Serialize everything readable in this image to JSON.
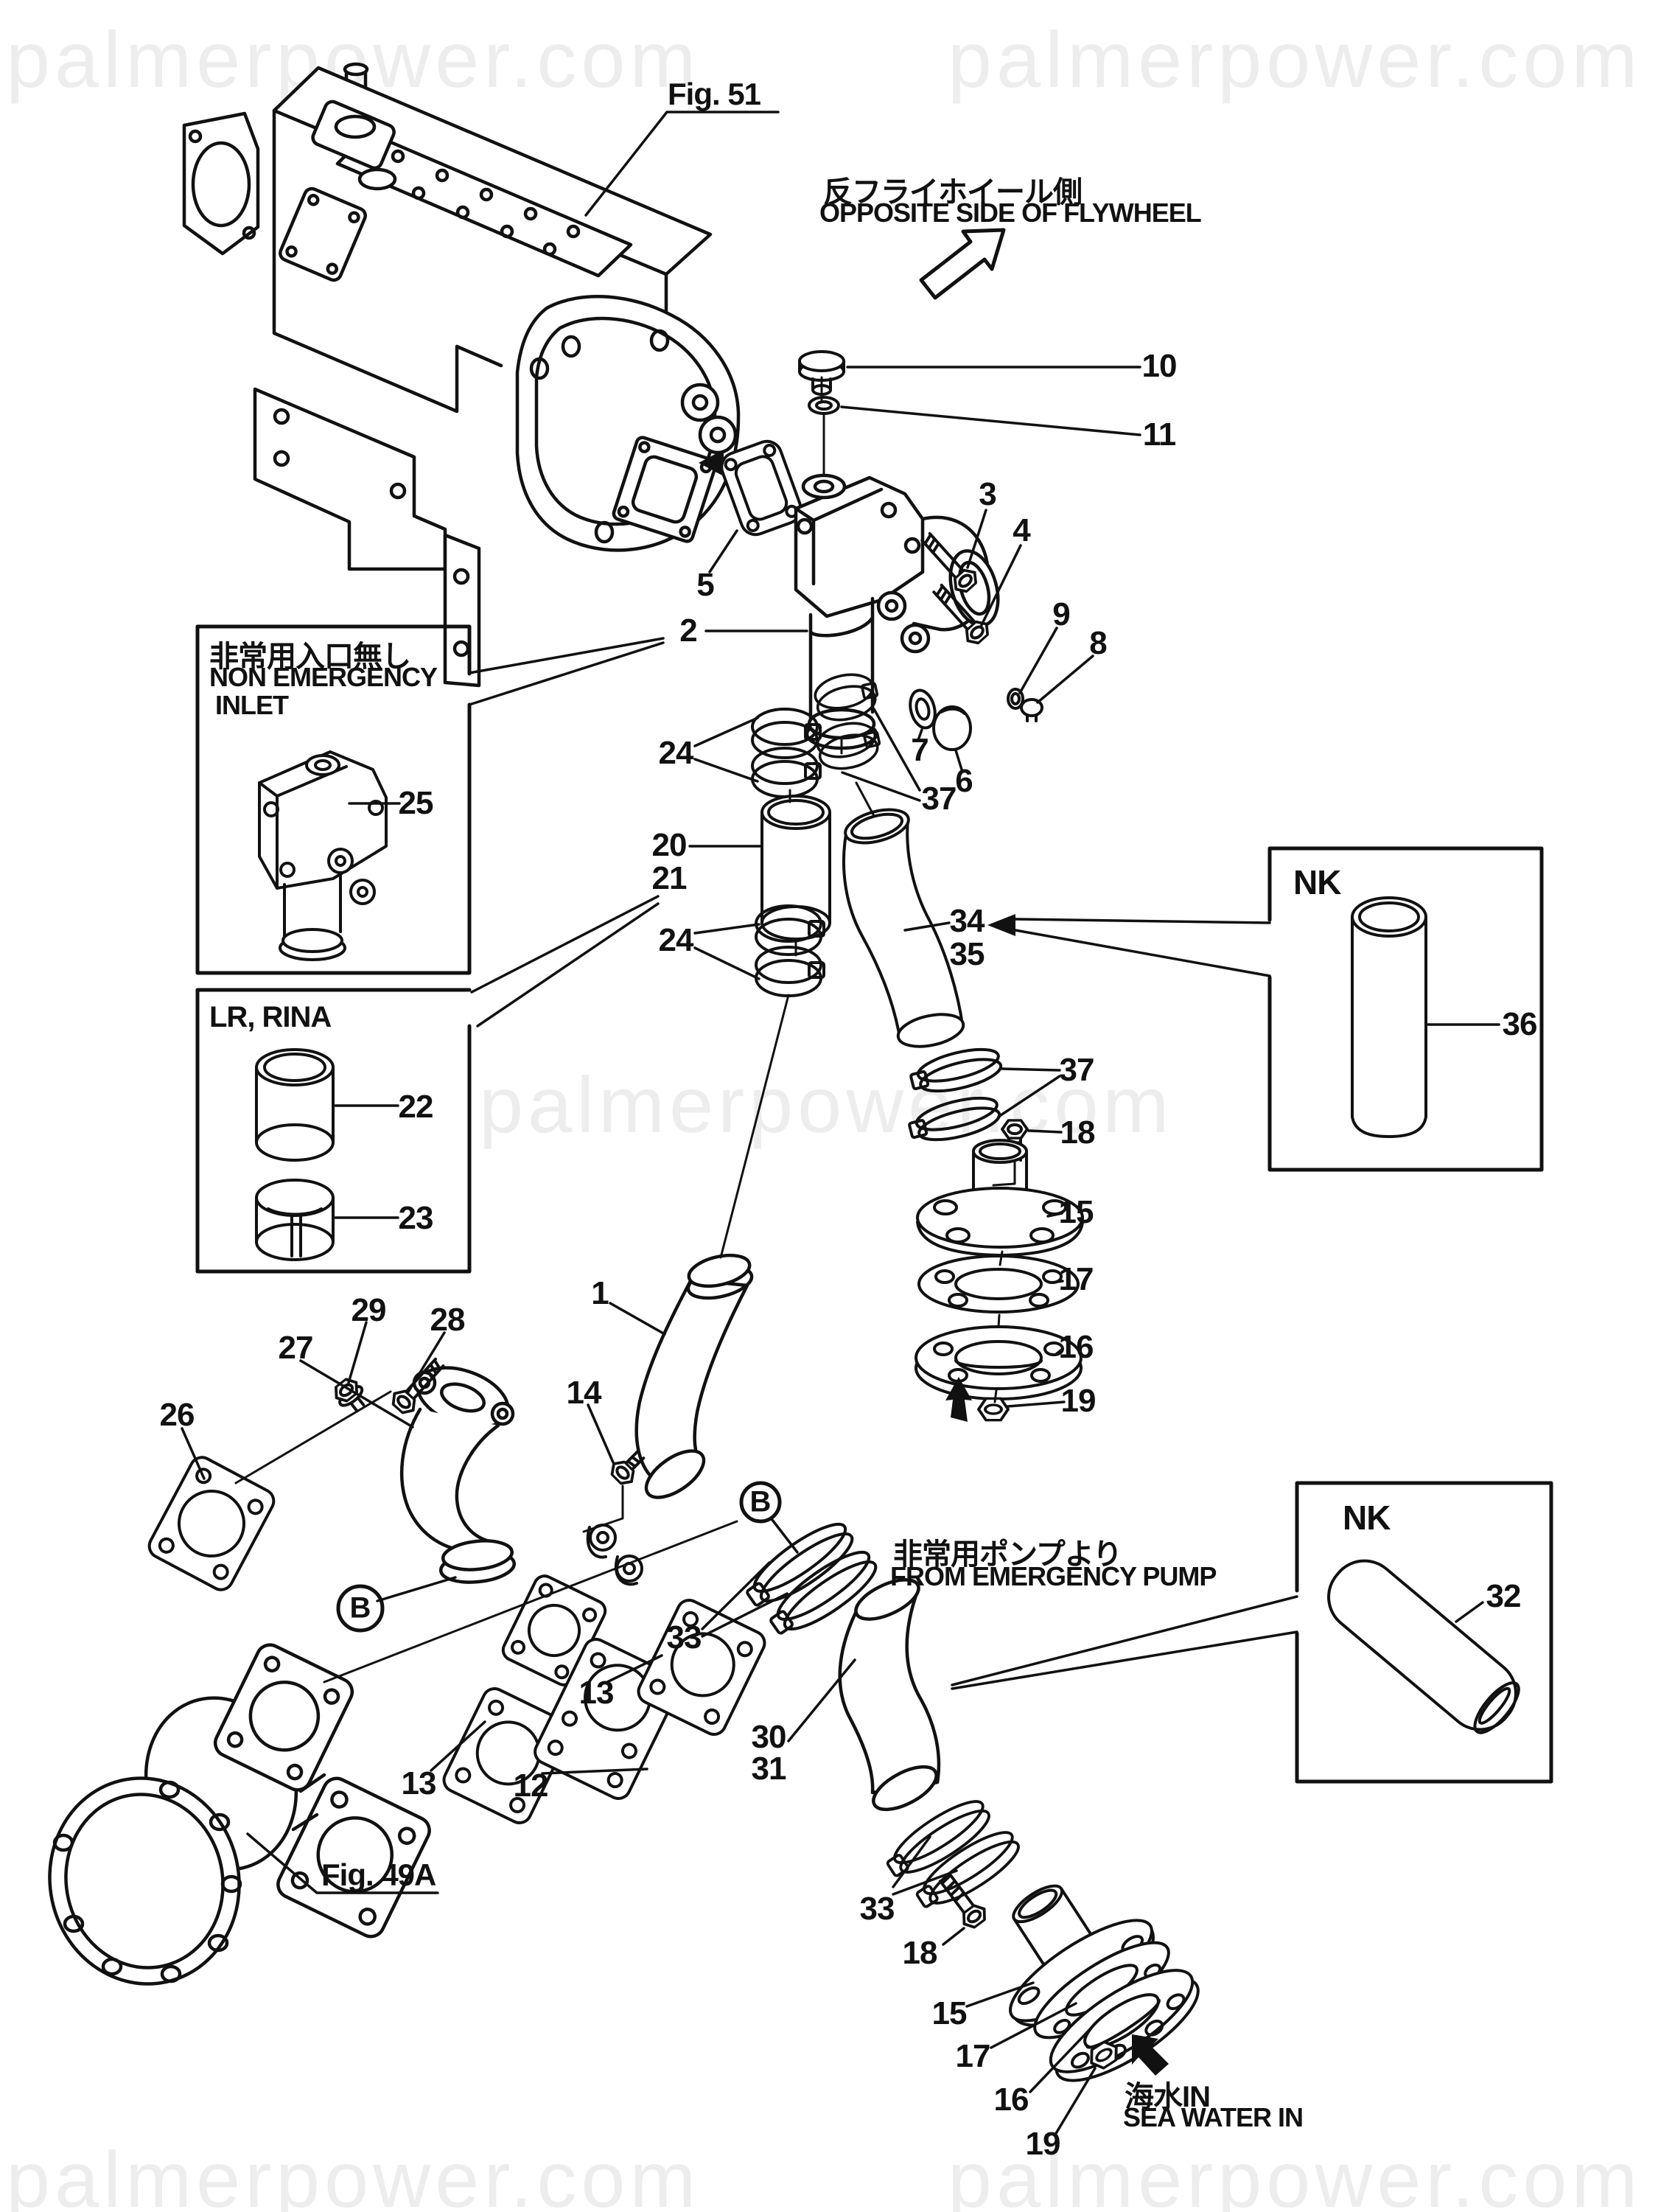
{
  "watermark": {
    "text": "palmerpower.com",
    "color": "#ededed"
  },
  "annotations": {
    "fig51": "Fig. 51",
    "fig49a": "Fig. 49A",
    "opposite_side_jp": "反フライホイール側",
    "opposite_side_en": "OPPOSITE SIDE OF FLYWHEEL",
    "from_emergency_pump_jp": "非常用ポンプより",
    "from_emergency_pump_en": "FROM EMERGENCY PUMP",
    "sea_water_in_jp": "海水IN",
    "sea_water_in_en": "SEA WATER IN",
    "view_marker": "B"
  },
  "boxes": {
    "non_emergency": {
      "title_jp": "非常用入口無し",
      "title_en1": "NON EMERGENCY",
      "title_en2": "INLET"
    },
    "lr_rina": {
      "title": "LR, RINA"
    },
    "nk_top": {
      "title": "NK"
    },
    "nk_bottom": {
      "title": "NK"
    }
  },
  "part_numbers": {
    "1": "1",
    "2": "2",
    "3": "3",
    "4": "4",
    "5": "5",
    "6": "6",
    "7": "7",
    "8": "8",
    "9": "9",
    "10": "10",
    "11": "11",
    "12": "12",
    "13": "13",
    "14": "14",
    "15": "15",
    "16": "16",
    "17": "17",
    "18": "18",
    "19": "19",
    "20": "20",
    "21": "21",
    "22": "22",
    "23": "23",
    "24": "24",
    "25": "25",
    "26": "26",
    "27": "27",
    "28": "28",
    "29": "29",
    "30": "30",
    "31": "31",
    "32": "32",
    "33": "33",
    "34": "34",
    "35": "35",
    "36": "36",
    "37": "37"
  }
}
